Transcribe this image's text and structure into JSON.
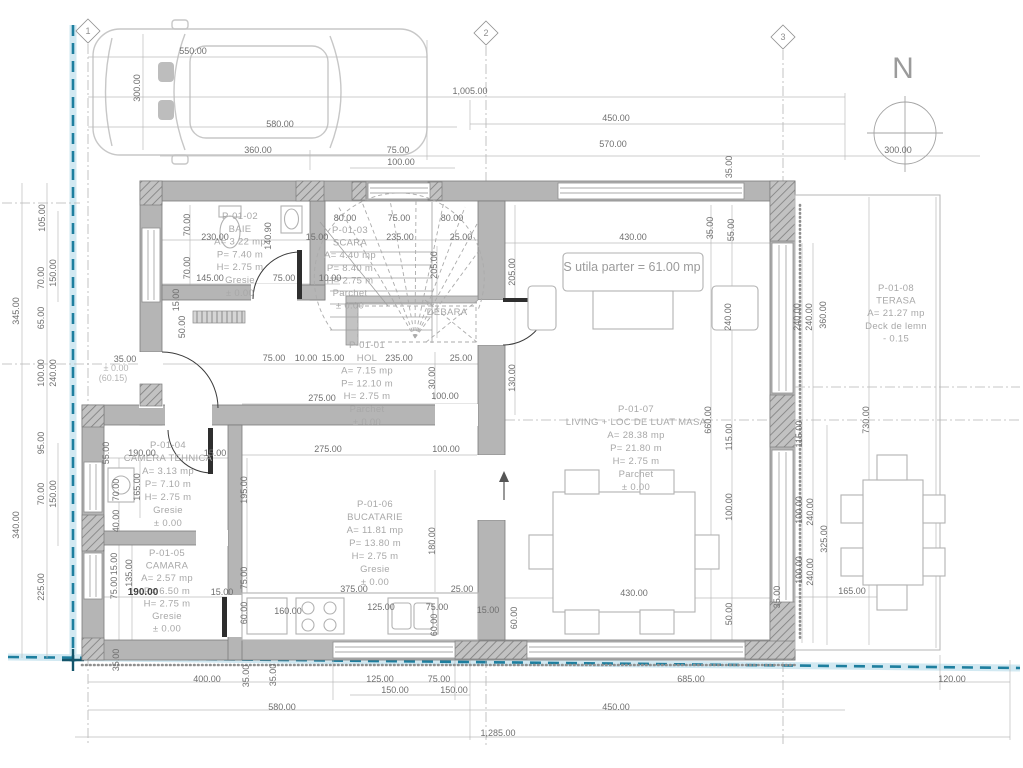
{
  "north_label": "N",
  "area_summary": "S utila parter = 61.00 mp",
  "boundary_color": "#1e7f9f",
  "wall_color": "#b5b5b5",
  "grid_markers": [
    {
      "label": "1",
      "x": 88,
      "y": 31
    },
    {
      "label": "2",
      "x": 486,
      "y": 33
    },
    {
      "label": "3",
      "x": 783,
      "y": 37
    }
  ],
  "rooms": [
    {
      "id": "P-01-02",
      "x": 240,
      "y": 219,
      "lh": 12.8,
      "lines": [
        "P-01-02",
        "BAIE",
        "A= 3.22 mp",
        "P= 7.40 m",
        "H= 2.75 m",
        "Gresie",
        "± 0.00"
      ]
    },
    {
      "id": "P-01-03",
      "x": 350,
      "y": 233,
      "lh": 12.6,
      "lines": [
        "P-01-03",
        "SCARA",
        "A= 4.40 mp",
        "P= 8.40 m",
        "H= 2.75 m",
        "Parchet",
        "± 0.00"
      ]
    },
    {
      "id": "DEBARA",
      "x": 447,
      "y": 315,
      "lh": 12,
      "lines": [
        "DEBARA"
      ]
    },
    {
      "id": "P-01-01",
      "x": 367,
      "y": 348,
      "lh": 12.8,
      "lines": [
        "P-01-01",
        "HOL",
        "A= 7.15 mp",
        "P= 12.10 m",
        "H= 2.75 m",
        "Parchet",
        "± 0.00"
      ]
    },
    {
      "id": "P-01-04",
      "x": 168,
      "y": 448,
      "lh": 13,
      "lines": [
        "P-01-04",
        "CAMERA TEHNICA",
        "A= 3.13 mp",
        "P= 7.10 m",
        "H= 2.75 m",
        "Gresie",
        "± 0.00"
      ]
    },
    {
      "id": "P-01-05",
      "x": 167,
      "y": 556,
      "lh": 12.6,
      "lines": [
        "P-01-05",
        "CAMARA",
        "A= 2.57 mp",
        "P= 6.50 m",
        "H= 2.75 m",
        "Gresie",
        "± 0.00"
      ]
    },
    {
      "id": "P-01-06",
      "x": 375,
      "y": 507,
      "lh": 13,
      "lines": [
        "P-01-06",
        "BUCATARIE",
        "A= 11.81 mp",
        "P= 13.80 m",
        "H= 2.75 m",
        "Gresie",
        "± 0.00"
      ]
    },
    {
      "id": "P-01-07",
      "x": 636,
      "y": 412,
      "lh": 13,
      "lines": [
        "P-01-07",
        "LIVING + LOC DE LUAT MASA",
        "A= 28.38 mp",
        "P= 21.80 m",
        "H= 2.75 m",
        "Parchet",
        "± 0.00"
      ]
    },
    {
      "id": "P-01-08",
      "x": 896,
      "y": 291,
      "lh": 12.6,
      "lines": [
        "P-01-08",
        "TERASA",
        "A= 21.27 mp",
        "Deck de lemn",
        "- 0.15"
      ]
    }
  ],
  "dimensions": [
    {
      "t": "550.00",
      "x": 193,
      "y": 54
    },
    {
      "t": "300.00",
      "x": 140,
      "y": 88,
      "r": -90
    },
    {
      "t": "1,005.00",
      "x": 470,
      "y": 94
    },
    {
      "t": "580.00",
      "x": 280,
      "y": 127
    },
    {
      "t": "450.00",
      "x": 616,
      "y": 121
    },
    {
      "t": "360.00",
      "x": 258,
      "y": 153
    },
    {
      "t": "75.00",
      "x": 398,
      "y": 153
    },
    {
      "t": "570.00",
      "x": 613,
      "y": 147
    },
    {
      "t": "100.00",
      "x": 401,
      "y": 165
    },
    {
      "t": "300.00",
      "x": 898,
      "y": 153
    },
    {
      "t": "35.00",
      "x": 732,
      "y": 167,
      "r": -90
    },
    {
      "t": "80.00",
      "x": 345,
      "y": 221
    },
    {
      "t": "75.00",
      "x": 399,
      "y": 221
    },
    {
      "t": "80.00",
      "x": 452,
      "y": 221
    },
    {
      "t": "230.00",
      "x": 215,
      "y": 240
    },
    {
      "t": "15.00",
      "x": 317,
      "y": 240
    },
    {
      "t": "235.00",
      "x": 400,
      "y": 240
    },
    {
      "t": "25.00",
      "x": 461,
      "y": 240
    },
    {
      "t": "140.90",
      "x": 271,
      "y": 236,
      "r": -90
    },
    {
      "t": "430.00",
      "x": 633,
      "y": 240
    },
    {
      "t": "35.00",
      "x": 713,
      "y": 228,
      "r": -90
    },
    {
      "t": "55.00",
      "x": 734,
      "y": 230,
      "r": -90
    },
    {
      "t": "105.00",
      "x": 45,
      "y": 218,
      "r": -90
    },
    {
      "t": "70.00",
      "x": 44,
      "y": 278,
      "r": -90
    },
    {
      "t": "150.00",
      "x": 56,
      "y": 273,
      "r": -90
    },
    {
      "t": "65.00",
      "x": 44,
      "y": 318,
      "r": -90
    },
    {
      "t": "345.00",
      "x": 19,
      "y": 311,
      "r": -90
    },
    {
      "t": "100.00",
      "x": 44,
      "y": 373,
      "r": -90
    },
    {
      "t": "240.00",
      "x": 56,
      "y": 373,
      "r": -90
    },
    {
      "t": "95.00",
      "x": 44,
      "y": 443,
      "r": -90
    },
    {
      "t": "70.00",
      "x": 44,
      "y": 494,
      "r": -90
    },
    {
      "t": "150.00",
      "x": 56,
      "y": 494,
      "r": -90
    },
    {
      "t": "340.00",
      "x": 19,
      "y": 525,
      "r": -90
    },
    {
      "t": "225.00",
      "x": 44,
      "y": 587,
      "r": -90
    },
    {
      "t": "70.00",
      "x": 190,
      "y": 225,
      "r": -90
    },
    {
      "t": "70.00",
      "x": 190,
      "y": 268,
      "r": -90
    },
    {
      "t": "35.00",
      "x": 125,
      "y": 362,
      "s": 8
    },
    {
      "t": "± 0.00",
      "x": 116,
      "y": 371,
      "c": "lt",
      "s": 8.5
    },
    {
      "t": "(60.15)",
      "x": 113,
      "y": 381,
      "c": "lt",
      "s": 8.5
    },
    {
      "t": "145.00",
      "x": 210,
      "y": 281
    },
    {
      "t": "75.00",
      "x": 284,
      "y": 281
    },
    {
      "t": "10.00",
      "x": 330,
      "y": 281
    },
    {
      "t": "15.00",
      "x": 179,
      "y": 300,
      "r": -90,
      "s": 8
    },
    {
      "t": "50.00",
      "x": 185,
      "y": 327,
      "r": -90,
      "s": 8
    },
    {
      "t": "75.00",
      "x": 274,
      "y": 361
    },
    {
      "t": "10.00",
      "x": 306,
      "y": 361
    },
    {
      "t": "15.00",
      "x": 333,
      "y": 361
    },
    {
      "t": "235.00",
      "x": 399,
      "y": 361
    },
    {
      "t": "25.00",
      "x": 461,
      "y": 361
    },
    {
      "t": "205.00",
      "x": 437,
      "y": 265,
      "r": -90
    },
    {
      "t": "205.00",
      "x": 515,
      "y": 272,
      "r": -90
    },
    {
      "t": "130.00",
      "x": 515,
      "y": 378,
      "r": -90
    },
    {
      "t": "30.00",
      "x": 435,
      "y": 378,
      "r": -90
    },
    {
      "t": "275.00",
      "x": 322,
      "y": 401
    },
    {
      "t": "100.00",
      "x": 445,
      "y": 399
    },
    {
      "t": "275.00",
      "x": 328,
      "y": 452
    },
    {
      "t": "100.00",
      "x": 446,
      "y": 452
    },
    {
      "t": "190.00",
      "x": 142,
      "y": 456
    },
    {
      "t": "15.00",
      "x": 215,
      "y": 456
    },
    {
      "t": "55.00",
      "x": 109,
      "y": 453,
      "r": -90
    },
    {
      "t": "70.00",
      "x": 119,
      "y": 490,
      "r": -90
    },
    {
      "t": "165.00",
      "x": 140,
      "y": 487,
      "r": -90
    },
    {
      "t": "40.00",
      "x": 119,
      "y": 521,
      "r": -90
    },
    {
      "t": "195.00",
      "x": 247,
      "y": 490,
      "r": -90
    },
    {
      "t": "15.00",
      "x": 117,
      "y": 564,
      "r": -90,
      "s": 8
    },
    {
      "t": "135.00",
      "x": 132,
      "y": 573,
      "r": -90
    },
    {
      "t": "75.00",
      "x": 117,
      "y": 588,
      "r": -90
    },
    {
      "t": "190.00",
      "x": 143,
      "y": 595,
      "c": "bold"
    },
    {
      "t": "15.00",
      "x": 222,
      "y": 595
    },
    {
      "t": "75.00",
      "x": 247,
      "y": 578,
      "r": -90
    },
    {
      "t": "60.00",
      "x": 247,
      "y": 613,
      "r": -90
    },
    {
      "t": "375.00",
      "x": 354,
      "y": 592
    },
    {
      "t": "25.00",
      "x": 462,
      "y": 592
    },
    {
      "t": "180.00",
      "x": 435,
      "y": 541,
      "r": -90
    },
    {
      "t": "160.00",
      "x": 288,
      "y": 614
    },
    {
      "t": "125.00",
      "x": 381,
      "y": 610
    },
    {
      "t": "75.00",
      "x": 437,
      "y": 610
    },
    {
      "t": "60.00",
      "x": 437,
      "y": 625,
      "r": -90,
      "s": 8
    },
    {
      "t": "15.00",
      "x": 488,
      "y": 613,
      "s": 8
    },
    {
      "t": "60.00",
      "x": 517,
      "y": 618,
      "r": -90,
      "s": 8
    },
    {
      "t": "660.00",
      "x": 711,
      "y": 420,
      "r": -90
    },
    {
      "t": "115.00",
      "x": 732,
      "y": 437,
      "r": -90
    },
    {
      "t": "100.00",
      "x": 732,
      "y": 507,
      "r": -90
    },
    {
      "t": "240.00",
      "x": 731,
      "y": 317,
      "r": -90
    },
    {
      "t": "50.00",
      "x": 732,
      "y": 614,
      "r": -90,
      "s": 8
    },
    {
      "t": "430.00",
      "x": 634,
      "y": 596
    },
    {
      "t": "240.00",
      "x": 800,
      "y": 317,
      "r": -90
    },
    {
      "t": "240.00",
      "x": 812,
      "y": 317,
      "r": -90
    },
    {
      "t": "360.00",
      "x": 826,
      "y": 315,
      "r": -90
    },
    {
      "t": "730.00",
      "x": 869,
      "y": 420,
      "r": -90
    },
    {
      "t": "115.00",
      "x": 802,
      "y": 434,
      "r": -90
    },
    {
      "t": "100.00",
      "x": 802,
      "y": 510,
      "r": -90
    },
    {
      "t": "240.00",
      "x": 813,
      "y": 512,
      "r": -90
    },
    {
      "t": "100.00",
      "x": 802,
      "y": 570,
      "r": -90,
      "s": 8
    },
    {
      "t": "240.00",
      "x": 813,
      "y": 572,
      "r": -90
    },
    {
      "t": "325.00",
      "x": 827,
      "y": 539,
      "r": -90
    },
    {
      "t": "165.00",
      "x": 852,
      "y": 594
    },
    {
      "t": "35.00",
      "x": 780,
      "y": 597,
      "r": -90,
      "s": 8
    },
    {
      "t": "35.00",
      "x": 119,
      "y": 660,
      "r": -90,
      "s": 8
    },
    {
      "t": "400.00",
      "x": 207,
      "y": 682
    },
    {
      "t": "35.00",
      "x": 249,
      "y": 676,
      "r": -90,
      "s": 8
    },
    {
      "t": "35.00",
      "x": 276,
      "y": 675,
      "r": -90,
      "s": 8
    },
    {
      "t": "125.00",
      "x": 380,
      "y": 682
    },
    {
      "t": "75.00",
      "x": 439,
      "y": 682
    },
    {
      "t": "150.00",
      "x": 395,
      "y": 693
    },
    {
      "t": "150.00",
      "x": 454,
      "y": 693
    },
    {
      "t": "685.00",
      "x": 691,
      "y": 682
    },
    {
      "t": "120.00",
      "x": 952,
      "y": 682
    },
    {
      "t": "580.00",
      "x": 282,
      "y": 710
    },
    {
      "t": "450.00",
      "x": 616,
      "y": 710
    },
    {
      "t": "1,285.00",
      "x": 498,
      "y": 736
    }
  ]
}
